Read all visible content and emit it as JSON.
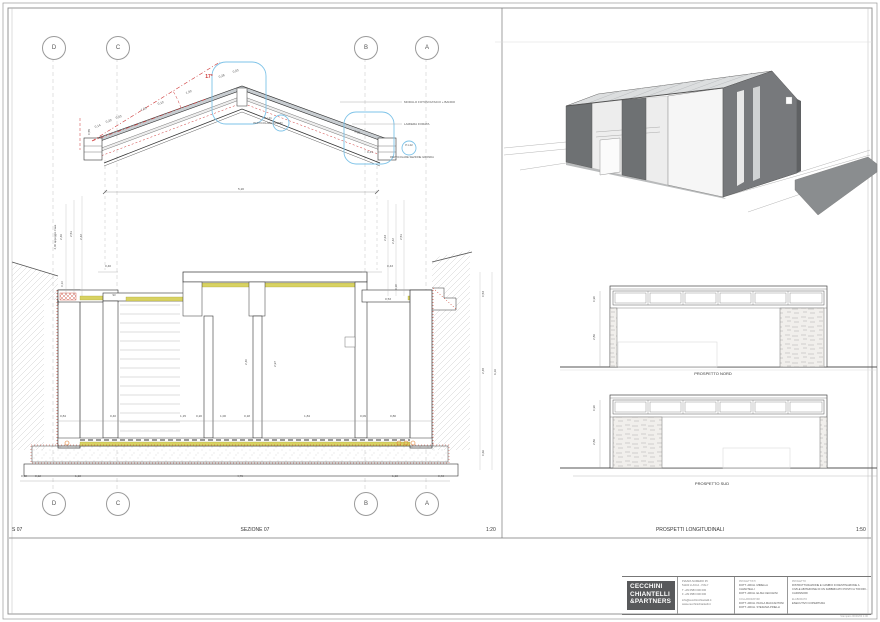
{
  "sheet": {
    "section_strip": {
      "code": "S 07",
      "title": "SEZIONE 07",
      "scale": "1:20"
    },
    "elevation_strip": {
      "title": "PROSPETTI LONGITUDINALI",
      "scale": "1:50"
    },
    "elevation_titles": {
      "north": "PROSPETTO NORD",
      "south": "PROSPETTO SUD"
    },
    "grid_markers": {
      "top": [
        "D",
        "C",
        "B",
        "A"
      ],
      "bottom": [
        "D",
        "C",
        "B",
        "A"
      ]
    }
  },
  "colors": {
    "annotation_red": "#cc3333",
    "callout_blue": "#7ec3e8",
    "insulation_yellow": "#d8d262",
    "logo_background": "#58595b"
  },
  "drawing_labels": [
    {
      "t": "17°",
      "x": 209,
      "y": 78,
      "s": 5,
      "c": "#cc3333",
      "b": true
    },
    {
      "t": "MODULO FOTOVOLTAICO + BANDO",
      "x": 404,
      "y": 103,
      "a": "start",
      "s": 3
    },
    {
      "t": "LAMIERA FORATA",
      "x": 404,
      "y": 125,
      "a": "start",
      "s": 3
    },
    {
      "t": "P.1-01",
      "x": 268,
      "y": 119,
      "s": 2.7
    },
    {
      "t": "PARTICOLARE COLMO",
      "x": 268,
      "y": 124,
      "s": 2.7
    },
    {
      "t": "P.1-02",
      "x": 409,
      "y": 146,
      "s": 2.7
    },
    {
      "t": "PARTICOLARE SEZIONE GRONDA",
      "x": 412,
      "y": 158,
      "s": 2.7
    },
    {
      "t": "5,20",
      "x": 241,
      "y": 190
    },
    {
      "t": "0,55",
      "x": 90,
      "y": 132,
      "r": -90
    },
    {
      "t": "0,14",
      "x": 98,
      "y": 127,
      "r": -20
    },
    {
      "t": "0,20",
      "x": 109,
      "y": 122,
      "r": -20
    },
    {
      "t": "0,03",
      "x": 119,
      "y": 118,
      "r": -20
    },
    {
      "t": "1,00",
      "x": 144,
      "y": 110,
      "r": -20
    },
    {
      "t": "0,10",
      "x": 161,
      "y": 104,
      "r": -20
    },
    {
      "t": "1,90",
      "x": 189,
      "y": 93,
      "r": -20
    },
    {
      "t": "0,28",
      "x": 222,
      "y": 77,
      "r": -20
    },
    {
      "t": "0,03",
      "x": 236,
      "y": 72,
      "r": -20
    },
    {
      "t": "0,85",
      "x": 357,
      "y": 133,
      "r": 20
    },
    {
      "t": "0,41",
      "x": 370,
      "y": 153
    },
    {
      "t": "2,00 appoggio trave",
      "x": 56,
      "y": 237,
      "r": -90,
      "s": 2.8
    },
    {
      "t": "2,46",
      "x": 62,
      "y": 237,
      "r": -90
    },
    {
      "t": "2,51",
      "x": 72,
      "y": 234,
      "r": -90
    },
    {
      "t": "2,42",
      "x": 82,
      "y": 237,
      "r": -90
    },
    {
      "t": "0,40",
      "x": 108,
      "y": 267
    },
    {
      "t": "0,13",
      "x": 63,
      "y": 284,
      "r": -90,
      "s": 2.8
    },
    {
      "t": "0,17",
      "x": 59,
      "y": 302,
      "r": -90,
      "s": 2.8
    },
    {
      "t": "93",
      "x": 114,
      "y": 296,
      "s": 2.8
    },
    {
      "t": "2,63",
      "x": 386,
      "y": 238,
      "r": -90
    },
    {
      "t": "2,42",
      "x": 394,
      "y": 241,
      "r": -90
    },
    {
      "t": "2,51",
      "x": 402,
      "y": 237,
      "r": -90
    },
    {
      "t": "0,43",
      "x": 390,
      "y": 267
    },
    {
      "t": "0,53",
      "x": 388,
      "y": 300
    },
    {
      "t": "0,18",
      "x": 397,
      "y": 287,
      "r": -90,
      "s": 2.8
    },
    {
      "t": "2,40",
      "x": 247,
      "y": 362,
      "r": -90
    },
    {
      "t": "2,97",
      "x": 276,
      "y": 364,
      "r": -90
    },
    {
      "t": "0,53",
      "x": 484,
      "y": 294,
      "r": -90
    },
    {
      "t": "2,48",
      "x": 484,
      "y": 371,
      "r": -90
    },
    {
      "t": "0,66",
      "x": 484,
      "y": 453,
      "r": -90
    },
    {
      "t": "6,16",
      "x": 496,
      "y": 372,
      "r": -90
    },
    {
      "t": "0,84",
      "x": 63,
      "y": 417
    },
    {
      "t": "0,40",
      "x": 113,
      "y": 417
    },
    {
      "t": "1,15",
      "x": 183,
      "y": 417
    },
    {
      "t": "0,20",
      "x": 199,
      "y": 417
    },
    {
      "t": "1,00",
      "x": 223,
      "y": 417
    },
    {
      "t": "0,18",
      "x": 247,
      "y": 417
    },
    {
      "t": "1,84",
      "x": 307,
      "y": 417
    },
    {
      "t": "0,09",
      "x": 363,
      "y": 417
    },
    {
      "t": "0,80",
      "x": 393,
      "y": 417
    },
    {
      "t": "0,38",
      "x": 24,
      "y": 477
    },
    {
      "t": "0,12",
      "x": 38,
      "y": 477
    },
    {
      "t": "1,10",
      "x": 78,
      "y": 477
    },
    {
      "t": "4,76",
      "x": 240,
      "y": 477
    },
    {
      "t": "1,10",
      "x": 395,
      "y": 477
    },
    {
      "t": "0,43",
      "x": 441,
      "y": 477
    },
    {
      "t": "0,90",
      "x": 595,
      "y": 299,
      "r": -90
    },
    {
      "t": "2,86",
      "x": 595,
      "y": 337,
      "r": -90
    },
    {
      "t": "0,90",
      "x": 595,
      "y": 408,
      "r": -90
    },
    {
      "t": "2,86",
      "x": 595,
      "y": 442,
      "r": -90
    }
  ],
  "titleblock": {
    "firm_name_lines": [
      "CECCHINI",
      "CHIANTELLI",
      "&PARTNERS"
    ],
    "address_lines": [
      "PIAZZA NUMERO 35",
      "51100 LUCCA - ITALY",
      "T +39 0583 000 000",
      "F +39 0583 000 000",
      "info@cecchinichiantelli.it",
      "www.cecchinichiantelli.it"
    ],
    "progettisti_header": "PROGETTISTI",
    "progettisti": [
      "DOTT. ARCH. MIRELLA CHIANTELLI",
      "DOTT. ARCH. ELISA CECCHINI"
    ],
    "collaboratori_header": "COLLABORATORI",
    "collaboratori": [
      "DOTT. ARCH. PAOLA MACCANTONI",
      "DOTT. ARCH. STEFANIA PINELLI"
    ],
    "progetto_header": "PROGETTO",
    "progetto": "RISTRUTTURAZIONE E CAMBIO DI DESTINAZIONE A CIVILE ABITAZIONE DI UN FABBRICATO POSTO A TOFORI - CAPANNORI",
    "elaborato_header": "ELABORATO",
    "elaborato": "ESECUTIVO COPERTURA",
    "print_note": "Stampato 00/00/00 1:00"
  }
}
